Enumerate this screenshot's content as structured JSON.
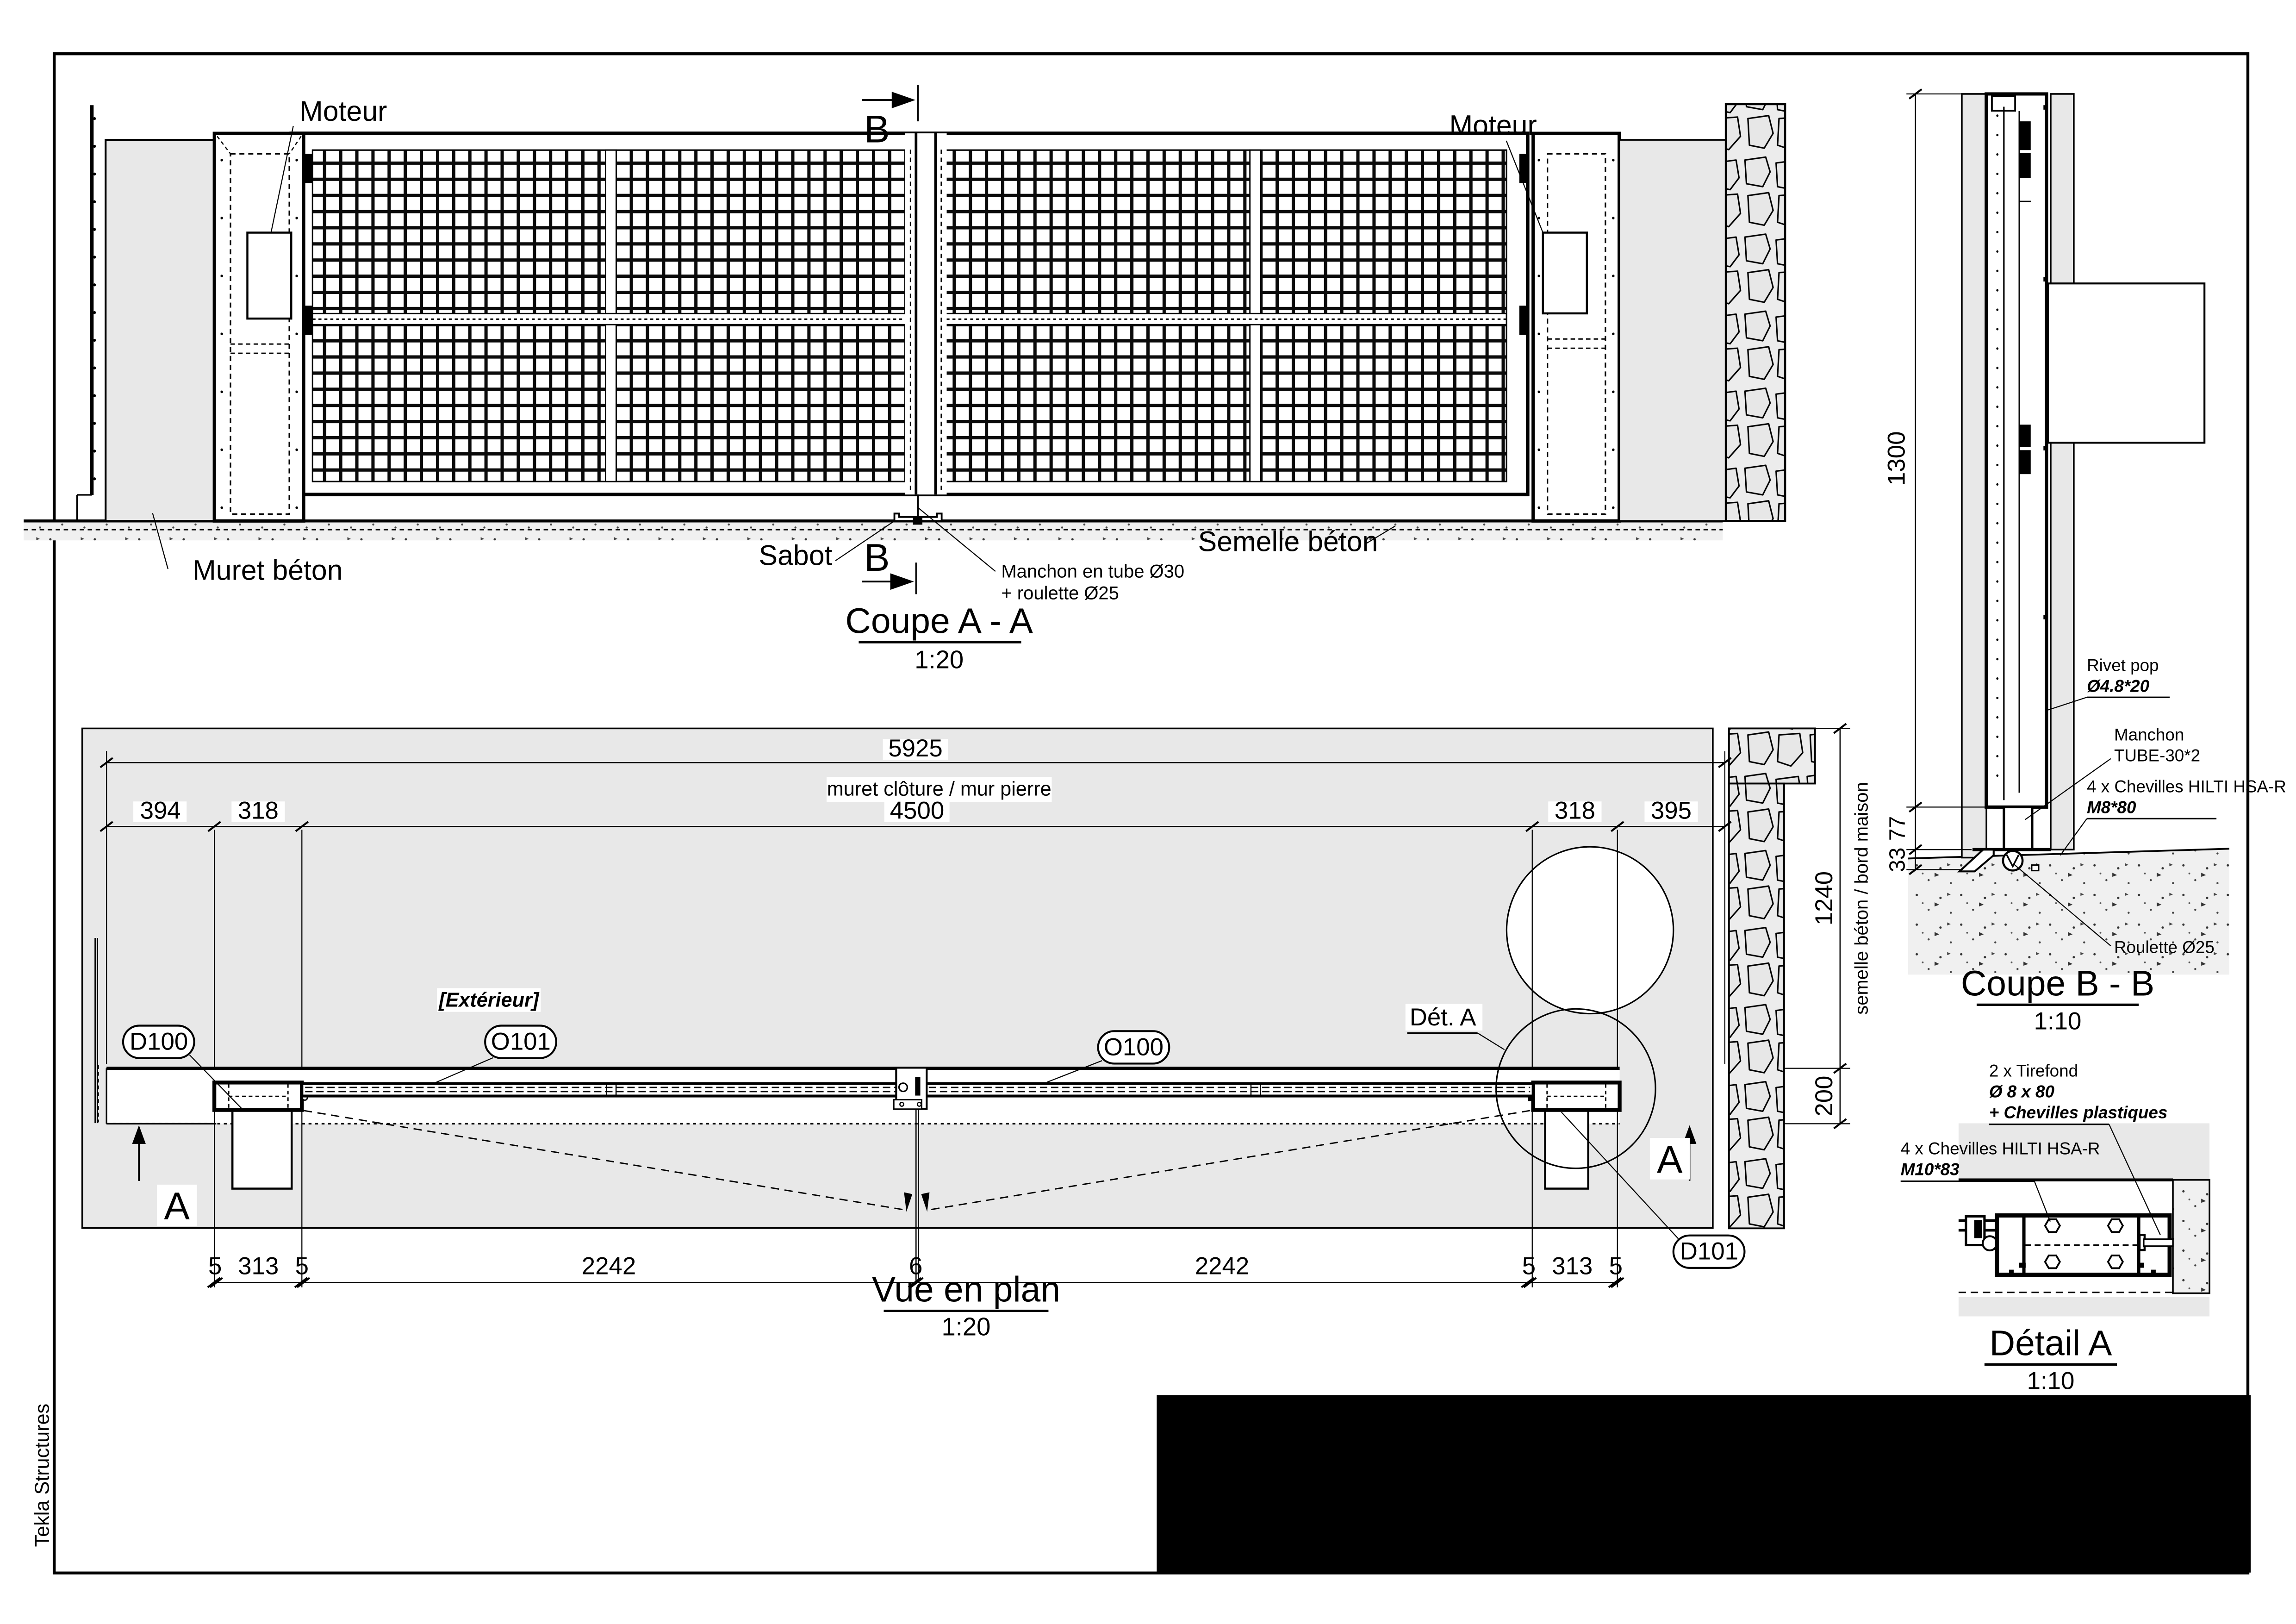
{
  "sheet": {
    "brand": "Tekla Structures"
  },
  "coupe_aa": {
    "title": "Coupe A - A",
    "scale": "1:20",
    "moteur_left": "Moteur",
    "moteur_right": "Moteur",
    "muret": "Muret béton",
    "sabot": "Sabot",
    "manchon1": "Manchon en tube Ø30",
    "manchon2": "+ roulette Ø25",
    "semelle": "Semelle béton",
    "b_mark": "B"
  },
  "plan": {
    "title": "Vue en plan",
    "scale": "1:20",
    "exterieur": "[Extérieur]",
    "muret_cloture": "muret clôture / mur pierre",
    "semelle_bord": "semelle béton / bord maison",
    "det_a": "Dét. A",
    "a_mark": "A",
    "bubbles": {
      "d100": "D100",
      "o101": "O101",
      "o100": "O100",
      "d101": "D101"
    },
    "dims": {
      "total": "5925",
      "d394": "394",
      "d318l": "318",
      "d4500": "4500",
      "d318r": "318",
      "d395": "395",
      "d1240": "1240",
      "d200": "200",
      "g5a": "5",
      "p313l": "313",
      "g5b": "5",
      "leaf_l": "2242",
      "center6": "6",
      "leaf_r": "2242",
      "g5c": "5",
      "p313r": "313",
      "g5d": "5"
    }
  },
  "coupe_bb": {
    "title": "Coupe B - B",
    "scale": "1:10",
    "dims": {
      "h1300": "1300",
      "d77": "77",
      "d33": "33"
    },
    "rivet1": "Rivet pop",
    "rivet2": "Ø4.8*20",
    "manchon1": "Manchon",
    "manchon2": "TUBE-30*2",
    "chev1": "4 x Chevilles HILTI HSA-R",
    "chev2": "M8*80",
    "roulette": "Roulette Ø25"
  },
  "detail_a": {
    "title": "Détail A",
    "scale": "1:10",
    "tirefond1": "2 x Tirefond",
    "tirefond2": "Ø 8 x 80",
    "tirefond3": "+ Chevilles plastiques",
    "chev1": "4 x Chevilles HILTI HSA-R",
    "chev2": "M10*83"
  },
  "colors": {
    "line": "#000000",
    "gray_fill": "#e8e8e8",
    "concrete_bg": "#f0f0f0",
    "paper": "#ffffff"
  }
}
